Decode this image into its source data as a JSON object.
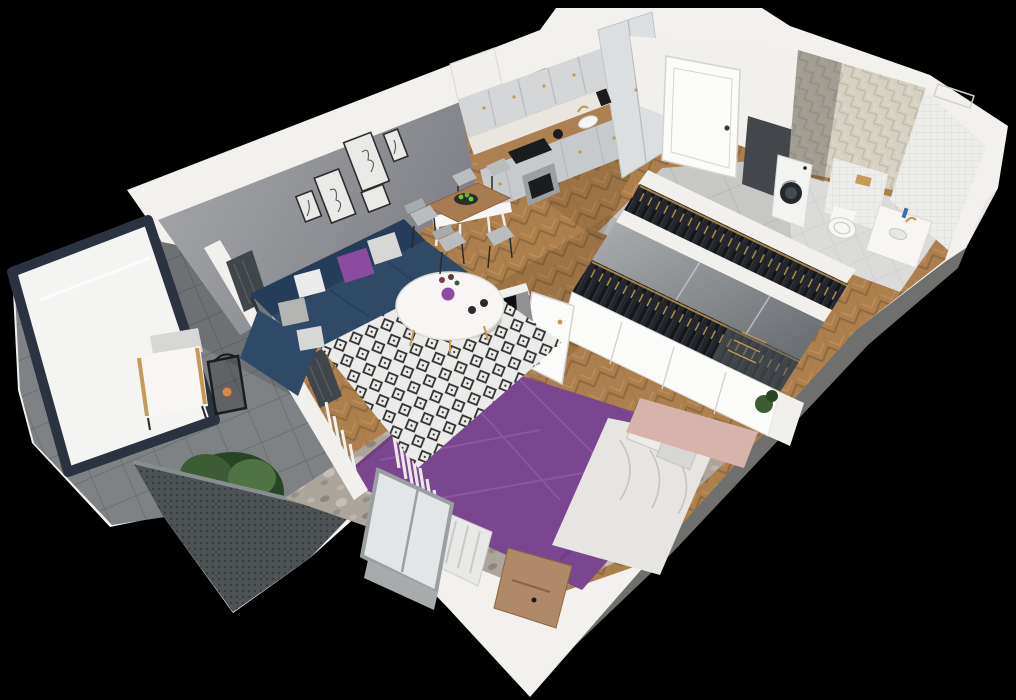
{
  "scene": {
    "type": "3d-floorplan-cutaway-render",
    "description": "Isometric top-down cutaway 3D render of a furnished one-bedroom apartment with balcony",
    "width": 1016,
    "height": 700,
    "background": "#000000"
  },
  "rooms": [
    {
      "id": "living-room",
      "label": "Living room"
    },
    {
      "id": "kitchen",
      "label": "Kitchen"
    },
    {
      "id": "entry-hall",
      "label": "Entry hall"
    },
    {
      "id": "bathroom",
      "label": "Bathroom"
    },
    {
      "id": "wardrobe-hall",
      "label": "Wardrobe corridor"
    },
    {
      "id": "bedroom",
      "label": "Bedroom"
    },
    {
      "id": "balcony",
      "label": "Balcony"
    }
  ],
  "objects": [
    "sectional-sofa",
    "coffee-table",
    "dining-table",
    "dining-chairs",
    "gallery-wall-frames",
    "kitchen-cabinets",
    "cooktop",
    "oven",
    "sink",
    "entry-door",
    "washing-machine",
    "toilet",
    "vanity-counter",
    "wardrobes-with-clothes",
    "sliding-mirror",
    "tv-partition-wall",
    "tv",
    "double-bed",
    "nightstand",
    "radiator",
    "sheer-curtains",
    "bedroom-window",
    "balcony-armchair",
    "lantern",
    "potted-plant",
    "balcony-railing",
    "glass-screen",
    "dark-curtains",
    "balcony-door"
  ],
  "colors": {
    "background": "#000000",
    "wall_top": "#f2f1ee",
    "wall_face": "#f1f0ed",
    "wall_shade": "#dededb",
    "wall_gray_light": "#a6a8ac",
    "wall_gray_dark": "#7f8186",
    "tv_wall_light": "#a4a6aa",
    "tv_wall_dark": "#8d8f93",
    "floor_wood_mid": "#ad7f4d",
    "floor_wood_dark": "#8f6a3e",
    "floor_wood_light": "#c29260",
    "tile_entry": "#c7c8c6",
    "tile_entry_grout": "#b3b4b2",
    "tile_bath_floor": "#dbdbd9",
    "tile_bath_grout": "#c9c8c6",
    "herr_tile_base": "#d6d0c3",
    "herr_tile_line": "#c2bbab",
    "white_tile": "#ededeb",
    "white_tile_line": "#d8d7d4",
    "balcony_tile": "#7e8285",
    "balcony_tile_line": "#65696c",
    "railing": "#4d5255",
    "railing_dot": "#35393c",
    "railing_cap": "#888d90",
    "glass_frame": "#2b3340",
    "glass_white": "#f4f4f2",
    "glass_reflect": "#6f777b",
    "sofa": "#2e4a67",
    "sofa_dark": "#243d58",
    "pillow_purple": "#8d4ba0",
    "pillow_light": "#d7d7d5",
    "pillow_white": "#ebebe9",
    "pillow_gray": "#b4b4b2",
    "rug_bg": "#ebebe9",
    "rug_pattern": "#2f2f2f",
    "table_white": "#f7f6f4",
    "gold": "#c49a54",
    "wood_furniture": "#a87c50",
    "wood_furniture_dark": "#8a6540",
    "chair_gray": "#b9bdbd",
    "chair_leg": "#2a2a2a",
    "cabinet": "#d4d6d8",
    "cabinet_light": "#dcdfe1",
    "cabinet_shade": "#c7cacc",
    "cabinet_line": "#b7babc",
    "counter_wood": "#ad8052",
    "backsplash": "#e9e6e0",
    "appliance_steel": "#9ba0a3",
    "appliance_dark": "#1a1c1e",
    "door_white": "#fbfbf9",
    "door_line": "#d3d3cf",
    "door_handle": "#3a3d40",
    "tv_black": "#0e0f10",
    "bed_purple": "#7b4690",
    "bed_purple_light": "#935ca8",
    "bed_purple_dark": "#653877",
    "sheet_white": "#e7e5e2",
    "sheet_shade": "#c6c4c1",
    "headboard_pink": "#d6b3ab",
    "rug_bedroom": "#aca59c",
    "nightstand": "#b08969",
    "clothes_dark": "#23262c",
    "clothes_darker": "#15171b",
    "hanger_gold": "#c29a50",
    "mirror_light": "#abaeb1",
    "mirror_dark": "#6c6f73",
    "plant_green": "#3c5c34",
    "plant_dark": "#2a4526",
    "plant_light": "#4f7343",
    "toilet_white": "#f6f6f4",
    "washer_white": "#f3f3f1",
    "washer_door": "#24272b",
    "washer_door_inner": "#464b52",
    "curtain_dark": "#41464b",
    "curtain_fold": "#565b61",
    "curtain_sheer": "#f1f1ef",
    "window_frame": "#9aa0a2",
    "window_glass": "#e2e6e6",
    "frame_black": "#2e2e2e",
    "art_paper": "#e9e9e7",
    "shadow": "rgba(0,0,0,0.16)",
    "shadow_soft": "rgba(40,30,15,0.12)"
  }
}
